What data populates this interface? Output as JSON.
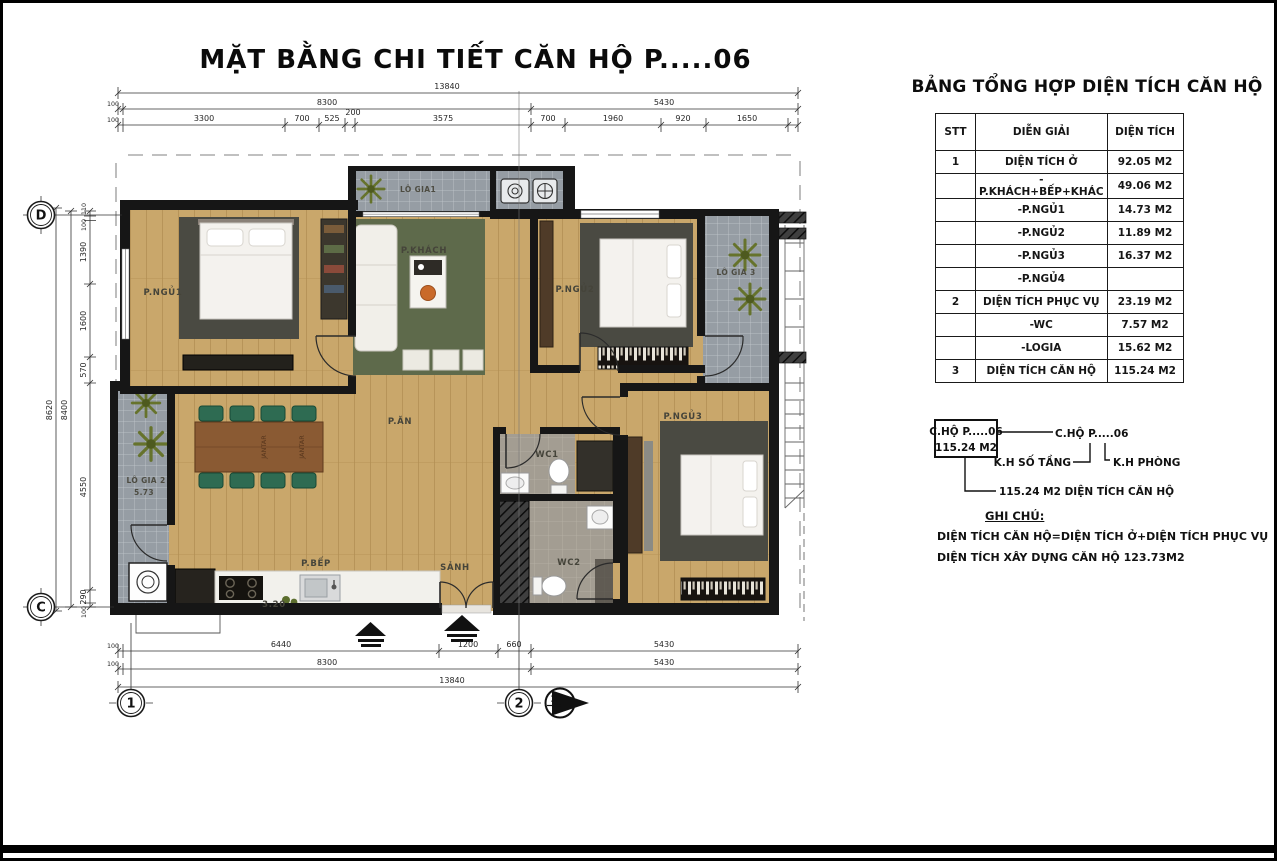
{
  "page": {
    "title": "MẶT BẰNG CHI TIẾT CĂN HỘ  P.....06"
  },
  "summary": {
    "title": "BẢNG TỔNG HỢP DIỆN TÍCH CĂN HỘ",
    "headers": [
      "STT",
      "DIỄN GIẢI",
      "DIỆN TÍCH"
    ],
    "rows": [
      {
        "stt": "1",
        "label": "DIỆN TÍCH Ở",
        "value": "92.05 M2"
      },
      {
        "stt": "",
        "label": "-P.KHÁCH+BẾP+KHÁC",
        "value": "49.06 M2"
      },
      {
        "stt": "",
        "label": "-P.NGỦ1",
        "value": "14.73 M2"
      },
      {
        "stt": "",
        "label": "-P.NGỦ2",
        "value": "11.89 M2"
      },
      {
        "stt": "",
        "label": "-P.NGỦ3",
        "value": "16.37 M2"
      },
      {
        "stt": "",
        "label": "-P.NGỦ4",
        "value": ""
      },
      {
        "stt": "2",
        "label": "DIỆN TÍCH PHỤC VỤ",
        "value": "23.19 M2"
      },
      {
        "stt": "",
        "label": "-WC",
        "value": "7.57 M2"
      },
      {
        "stt": "",
        "label": "-LOGIA",
        "value": "15.62 M2"
      },
      {
        "stt": "3",
        "label": "DIỆN TÍCH CĂN HỘ",
        "value": "115.24 M2"
      }
    ]
  },
  "key": {
    "box_line1": "C.HỘ P.....06",
    "box_line2": "115.24 M2",
    "ref_label": "C.HỘ P.....06",
    "floor_label": "K.H SỐ TẦNG",
    "room_label": "K.H PHÒNG",
    "area_label": "115.24 M2 DIỆN TÍCH CĂN HỘ"
  },
  "notes": {
    "title": "GHI CHÚ:",
    "line1": "DIỆN TÍCH CĂN HỘ=DIỆN TÍCH Ở+DIỆN TÍCH PHỤC VỤ",
    "line2": "DIỆN TÍCH XÂY DỰNG CĂN HỘ 123.73M2"
  },
  "plan": {
    "rooms": {
      "bedroom1": "P.NGỦ1",
      "bedroom2": "P.NGỦ2",
      "bedroom3": "P.NGỦ3",
      "living": "P.KHÁCH",
      "dining": "P.ĂN",
      "kitchen": "P.BẾP",
      "hall": "SẢNH",
      "wc1": "WC1",
      "wc2": "WC2",
      "logia1": "LÔ GIA1",
      "logia2": "LÔ GIA 2",
      "logia2_area": "5.73",
      "logia3": "LÔ GIA 3",
      "kitchen_area": "3.20",
      "table_text": "JANTAR"
    },
    "dims": {
      "top1": [
        "13840"
      ],
      "top2": [
        "100",
        "8300",
        "5430"
      ],
      "top3": [
        "100",
        "3300",
        "700",
        "525",
        "200",
        "3575",
        "700",
        "1960",
        "920",
        "1650"
      ],
      "bottom1": [
        "100",
        "6440",
        "1200",
        "660",
        "5430"
      ],
      "bottom2": [
        "100",
        "8300",
        "5430"
      ],
      "bottom3": [
        "13840"
      ],
      "left_overall": "8620",
      "left_inner": "8400",
      "left_segments": [
        "110",
        "100",
        "1390",
        "1600",
        "570",
        "4550",
        "290",
        "100"
      ]
    },
    "grid": {
      "row_top": "D",
      "row_bottom": "C",
      "col_left": "1",
      "col_right": "2",
      "section": "2"
    }
  },
  "colors": {
    "wall": "#161616",
    "floor_wood": "#c9a76b",
    "balcony_tile": "#969da4",
    "rug_dark": "#4a4a42",
    "rug_green": "#5e6a4b",
    "chair_green": "#2e6b52",
    "table_wood": "#8a5a33"
  }
}
